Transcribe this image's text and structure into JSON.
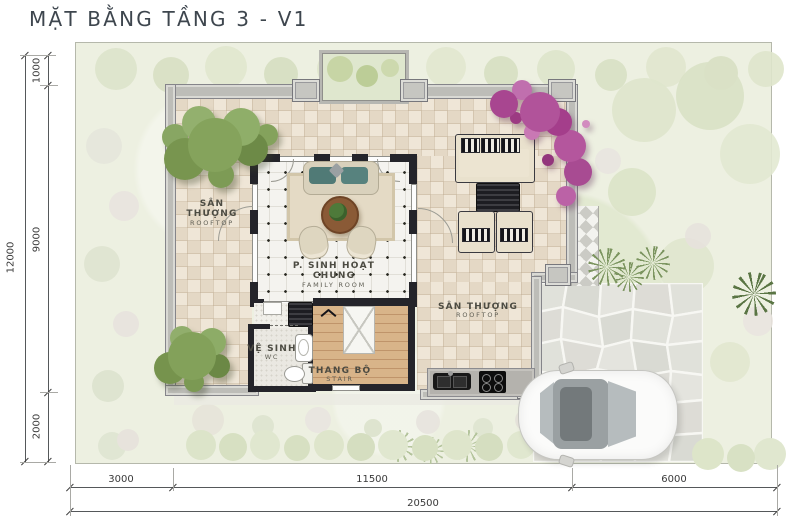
{
  "title": "MẶT BẰNG TẦNG 3 - V1",
  "rooms": {
    "rooftop_left": {
      "vi": "SÂN THƯỢNG",
      "en": "ROOFTOP"
    },
    "family_room": {
      "vi": "P. SINH HOẠT CHUNG",
      "en": "FAMILY ROOM"
    },
    "rooftop_right": {
      "vi": "SÂN THƯỢNG",
      "en": "ROOFTOP"
    },
    "wc": {
      "vi": "VỆ SINH",
      "en": "WC"
    },
    "stair": {
      "vi": "THANG BỘ",
      "en": "STAIR"
    }
  },
  "dimensions": {
    "left": {
      "total": "12000",
      "segments": [
        "1000",
        "9000",
        "2000"
      ]
    },
    "bottom": {
      "total": "20500",
      "segments": [
        "3000",
        "11500",
        "6000"
      ]
    }
  },
  "palette": {
    "tile_beige": "#e9decd",
    "wood": "#d0aa7d",
    "tree_green": "#85a35c",
    "flower_purple": "#b1539a",
    "cushion_teal": "#50797a",
    "garden_green": "#edf0e1"
  }
}
